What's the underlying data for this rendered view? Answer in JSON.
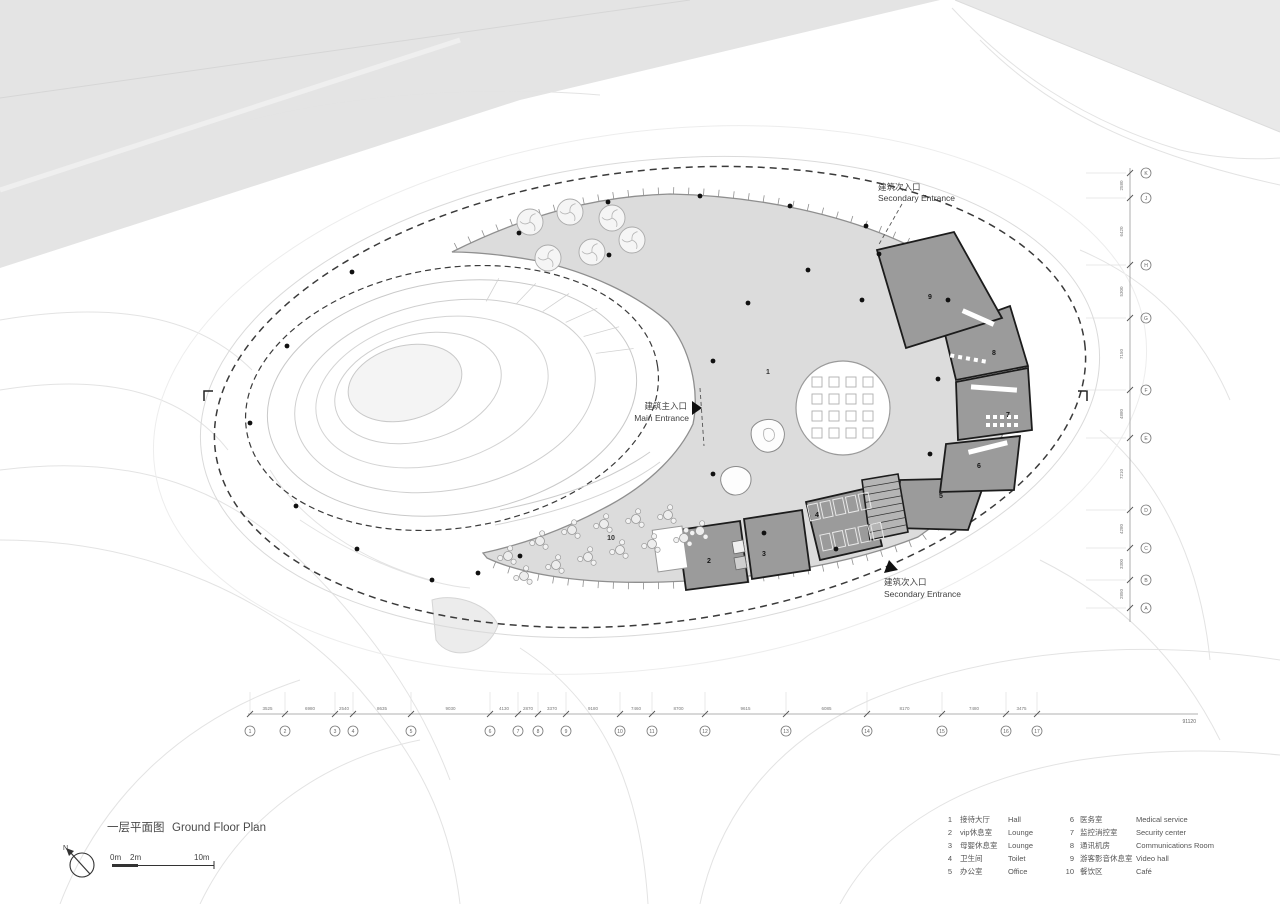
{
  "title": {
    "cn": "一层平面图",
    "en": "Ground Floor Plan"
  },
  "north_label": "N",
  "scale_bar": {
    "m0": "0m",
    "m2": "2m",
    "m10": "10m"
  },
  "entrances": {
    "top_secondary": {
      "cn": "建筑次入口",
      "en": "Secondary Entrance"
    },
    "main": {
      "cn": "建筑主入口",
      "en": "Main Entrance"
    },
    "bottom_secondary": {
      "cn": "建筑次入口",
      "en": "Secondary Entrance"
    }
  },
  "rooms": {
    "r1": "1",
    "r2": "2",
    "r3": "3",
    "r4": "4",
    "r5": "5",
    "r6": "6",
    "r7": "7",
    "r8": "8",
    "r9": "9",
    "r10": "10"
  },
  "legend": {
    "items": [
      {
        "no": "1",
        "cn": "接待大厅",
        "en": "Hall"
      },
      {
        "no": "2",
        "cn": "vip休息室",
        "en": "Lounge"
      },
      {
        "no": "3",
        "cn": "母婴休息室",
        "en": "Lounge"
      },
      {
        "no": "4",
        "cn": "卫生间",
        "en": "Toilet"
      },
      {
        "no": "5",
        "cn": "办公室",
        "en": "Office"
      },
      {
        "no": "6",
        "cn": "医务室",
        "en": "Medical service"
      },
      {
        "no": "7",
        "cn": "监控消控室",
        "en": "Security center"
      },
      {
        "no": "8",
        "cn": "通讯机房",
        "en": "Communications Room"
      },
      {
        "no": "9",
        "cn": "游客影音休息室",
        "en": "Video hall"
      },
      {
        "no": "10",
        "cn": "餐饮区",
        "en": "Café"
      }
    ]
  },
  "grid": {
    "bottom_bubbles": [
      "1",
      "2",
      "3",
      "4",
      "5",
      "6",
      "7",
      "8",
      "9",
      "10",
      "11",
      "12",
      "13",
      "14",
      "15",
      "16",
      "17"
    ],
    "bottom_dims": [
      "3525",
      "6980",
      "2540",
      "8635",
      "9030",
      "4130",
      "2870",
      "3370",
      "9180",
      "7460",
      "8700",
      "9615",
      "6085",
      "8170",
      "7480",
      "3475"
    ],
    "bottom_total": "91120",
    "right_bubbles": [
      "A",
      "B",
      "C",
      "D",
      "E",
      "F",
      "G",
      "H",
      "J",
      "K"
    ],
    "right_dims": [
      "2580",
      "6420",
      "5300",
      "7150",
      "4880",
      "7210",
      "4280",
      "3300",
      "2850"
    ]
  },
  "colors": {
    "floor": "#dcdcdc",
    "floor_stroke": "#8f8f8f",
    "room": "#9b9b9b",
    "wall": "#1c1c1c",
    "dash": "#3a3a3a",
    "contour": "#e3e3e3",
    "site_band": "#e4e4e4"
  }
}
